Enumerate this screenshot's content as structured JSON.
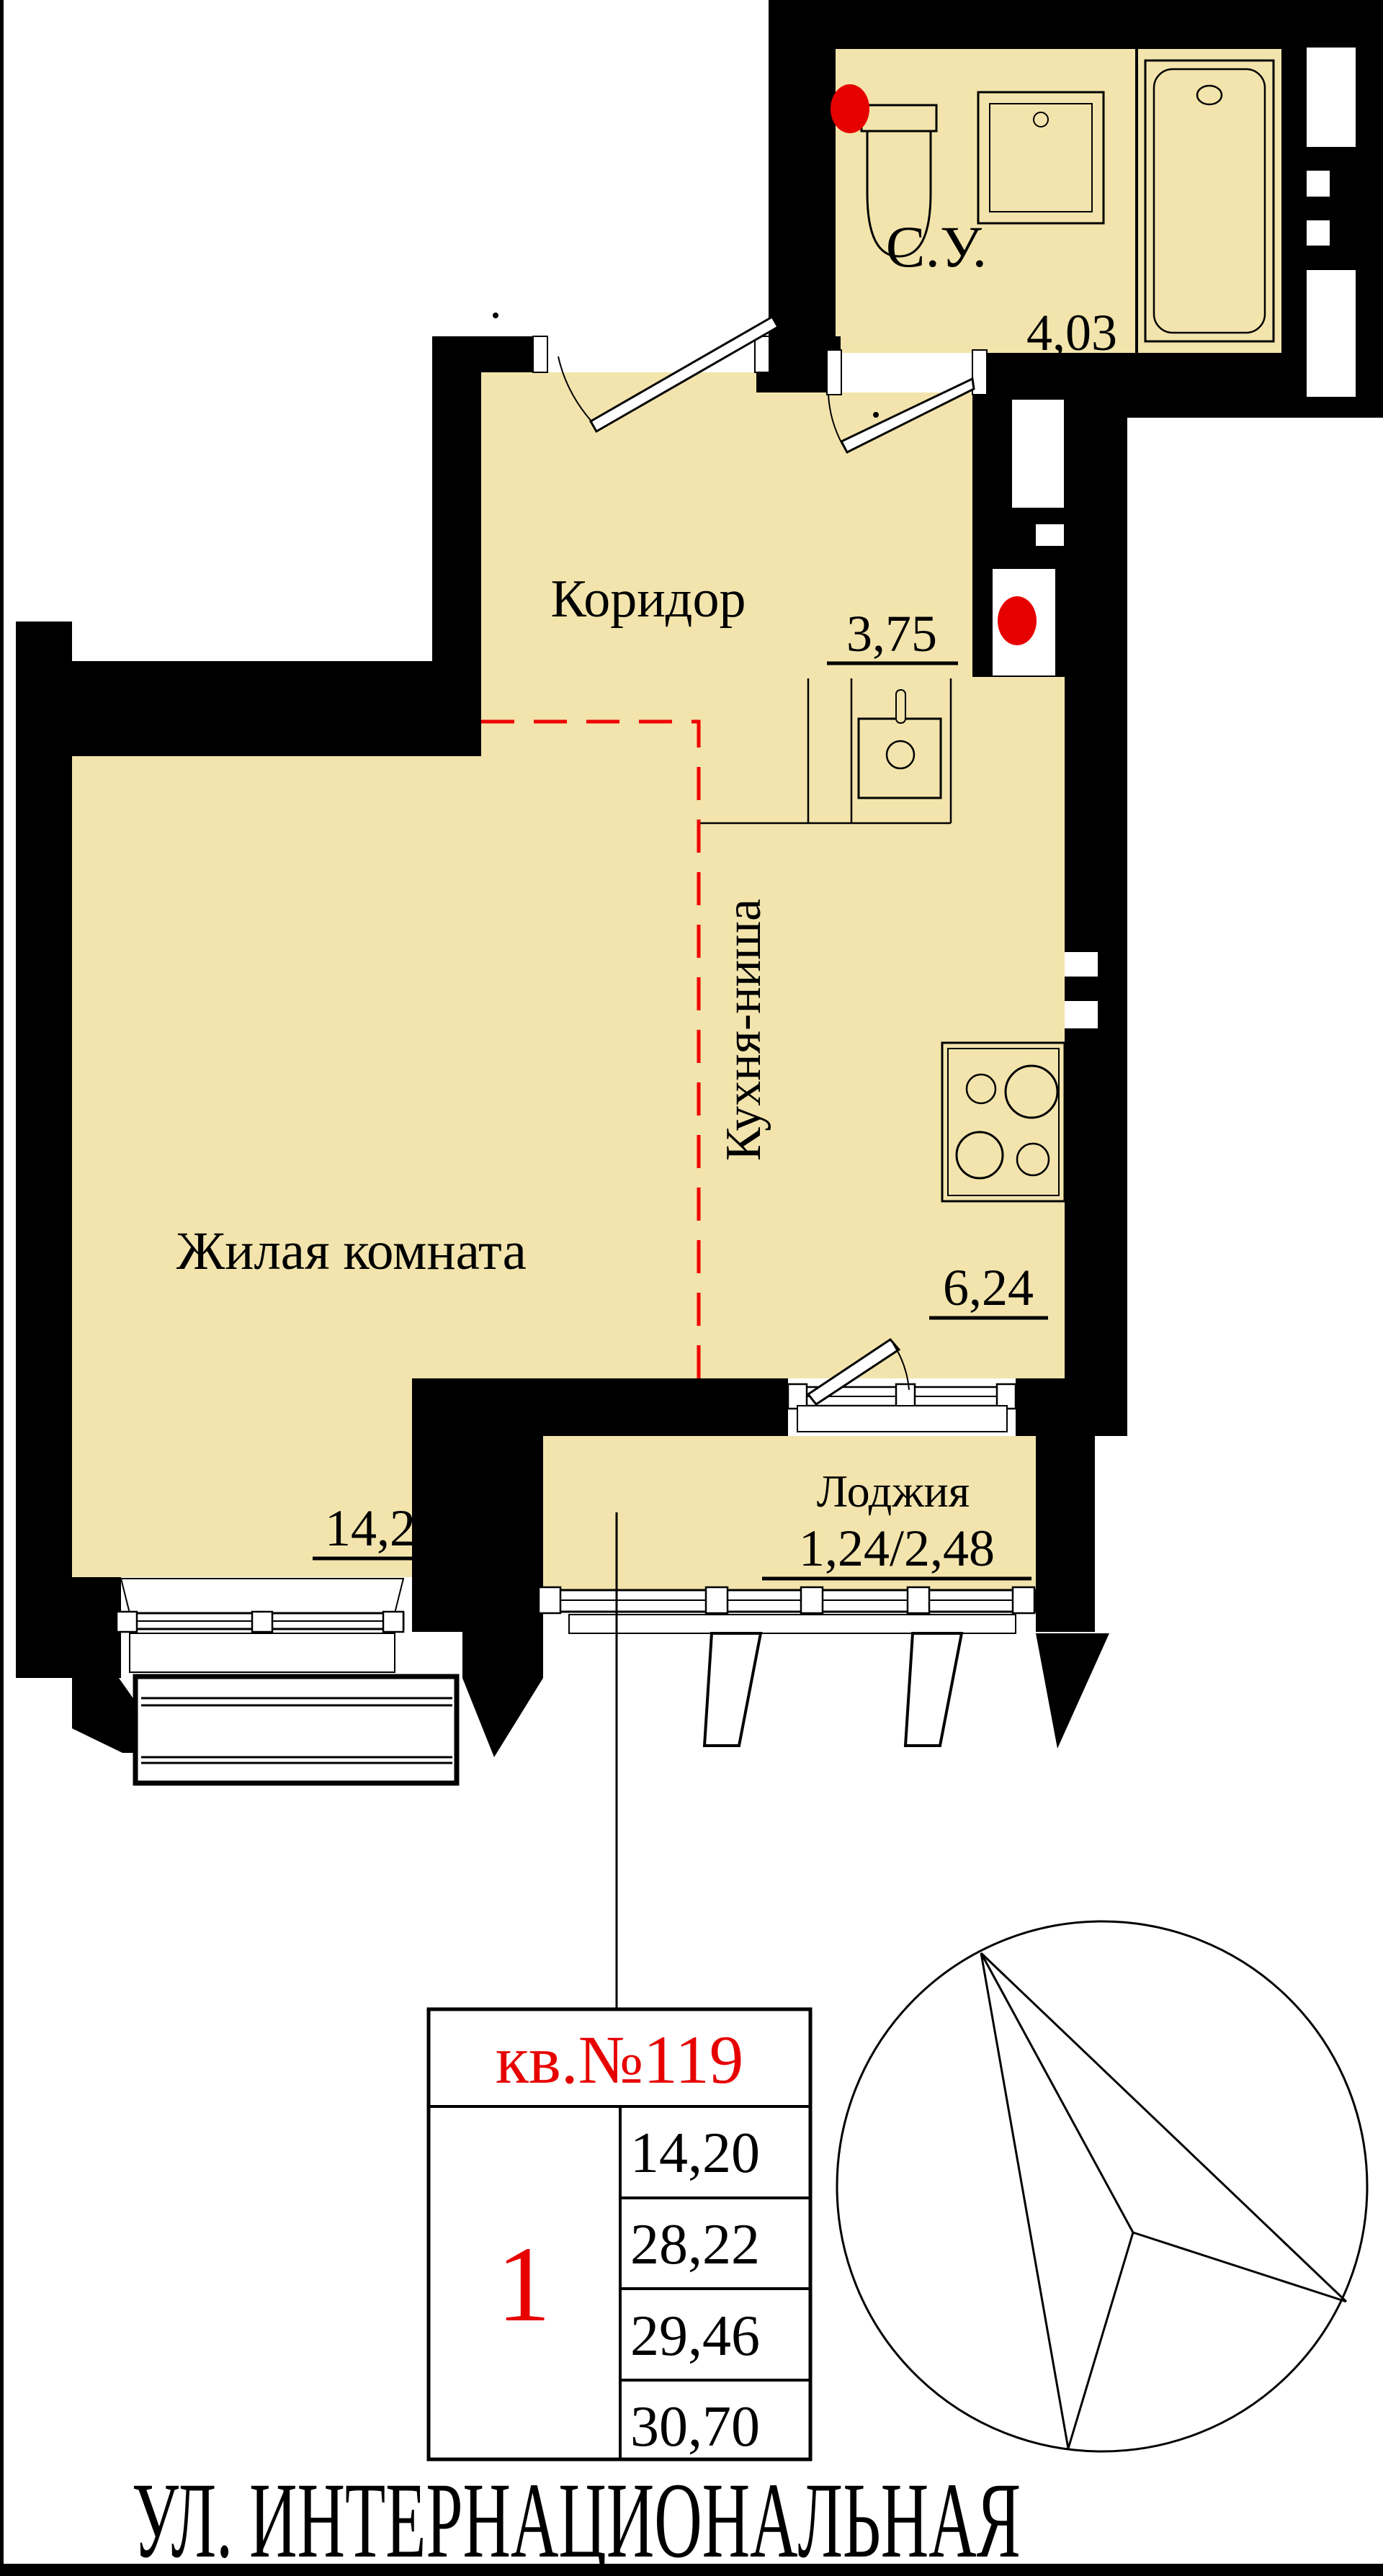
{
  "rooms": {
    "bathroom": {
      "name": "С.У.",
      "area": "4,03"
    },
    "corridor": {
      "name": "Коридор",
      "area": "3,75"
    },
    "kitchen": {
      "name": "Кухня-ниша",
      "area": "6,24"
    },
    "living": {
      "name": "Жилая комната",
      "area": "14,20"
    },
    "loggia": {
      "name": "Лоджия",
      "area": "1,24/2,48"
    }
  },
  "info_table": {
    "apartment_label": "кв.№119",
    "rooms_count": "1",
    "areas": [
      "14,20",
      "28,22",
      "29,46",
      "30,70"
    ]
  },
  "street_name": "УЛ. ИНТЕРНАЦИОНАЛЬНАЯ",
  "colors": {
    "room_fill": "#F2E4AC",
    "wall": "#000000",
    "accent_red": "#E60000"
  }
}
